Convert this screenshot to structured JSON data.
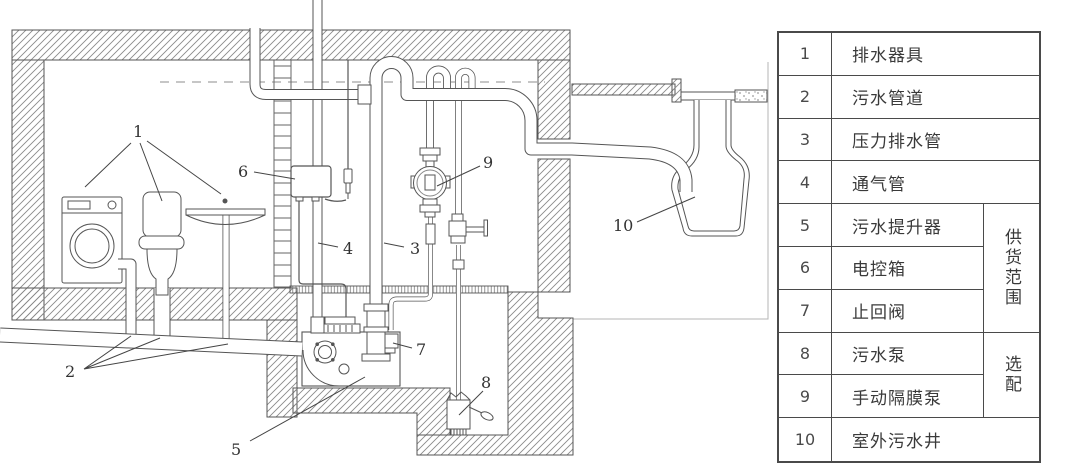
{
  "table": {
    "rows": [
      {
        "num": "1",
        "name": "排水器具"
      },
      {
        "num": "2",
        "name": "污水管道"
      },
      {
        "num": "3",
        "name": "压力排水管"
      },
      {
        "num": "4",
        "name": "通气管"
      },
      {
        "num": "5",
        "name": "污水提升器"
      },
      {
        "num": "6",
        "name": "电控箱"
      },
      {
        "num": "7",
        "name": "止回阀"
      },
      {
        "num": "8",
        "name": "污水泵"
      },
      {
        "num": "9",
        "name": "手动隔膜泵"
      },
      {
        "num": "10",
        "name": "室外污水井"
      }
    ],
    "supply_scope": "供货范围",
    "optional": "选配"
  },
  "diagram": {
    "labels": [
      "1",
      "2",
      "3",
      "4",
      "5",
      "6",
      "7",
      "8",
      "9",
      "10"
    ]
  },
  "colors": {
    "line": "#555555",
    "hatch": "#8a8a8a",
    "dashed_level": "#b3b3b3",
    "table_border": "#4a4a4a",
    "text": "#333333"
  }
}
